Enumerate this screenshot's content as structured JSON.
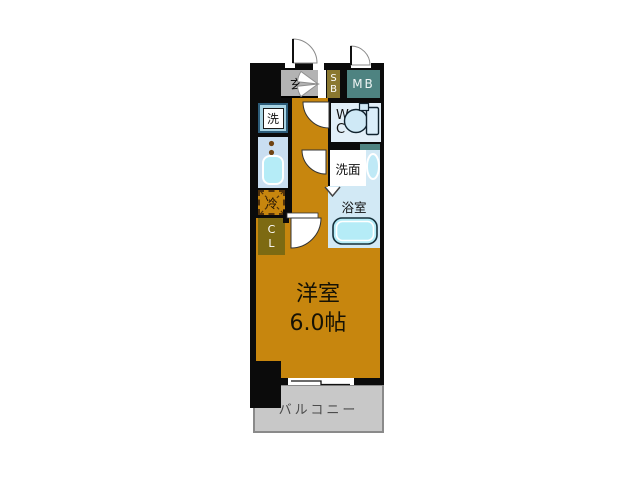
{
  "floor_plan": {
    "entrance": {
      "label": "玄"
    },
    "shoe_box": {
      "label": "S\nB"
    },
    "meter_box": {
      "label": "MB"
    },
    "toilet_room": {
      "label": "W\nC"
    },
    "laundry": {
      "label": "洗"
    },
    "refrigerator": {
      "label": "冷"
    },
    "closet": {
      "label": "C\nL"
    },
    "washroom": {
      "label": "洗面"
    },
    "bathroom": {
      "label": "浴室"
    },
    "western_room": {
      "label": "洋室",
      "size": "6.0帖"
    },
    "balcony": {
      "label": "バルコニー"
    }
  },
  "colors": {
    "wall_black": "#0b0b0b",
    "floor_orange": "#c7860e",
    "entrance_gray": "#b3b3b3",
    "shoe_box_olive": "#8a7830",
    "meter_box_teal": "#4e8381",
    "closet_olive": "#7d6a12",
    "wet_room_blue": "#e2eff8",
    "bath_blue": "#d2e9f5",
    "kitchen_blue": "#c9def1",
    "fixture_cyan": "#b5ecf7",
    "balcony_gray": "#c8c8c8",
    "balcony_border_gray": "#8a8a8a",
    "fridge_dash_brown": "#53320a",
    "burner_brown": "#6f4313"
  }
}
